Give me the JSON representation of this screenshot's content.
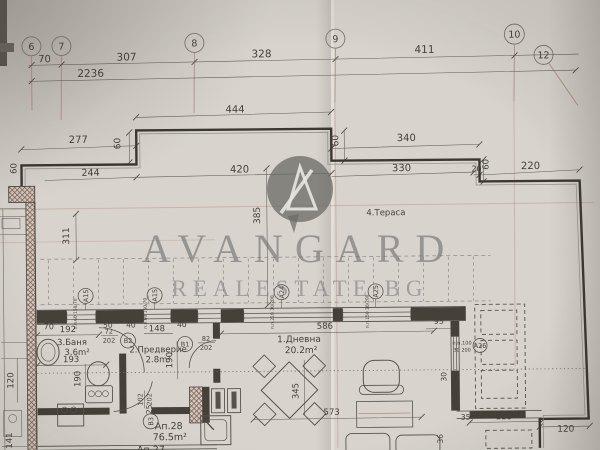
{
  "watermark": {
    "brand": "AVANGARD",
    "subtitle": "REALESTATE BG"
  },
  "grid_bubbles": {
    "b6": "6",
    "b7": "7",
    "b8": "8",
    "b9": "9",
    "b10": "10",
    "b12": "12"
  },
  "dims": {
    "d70": "70",
    "d307": "307",
    "d328": "328",
    "d411": "411",
    "d2236": "2236",
    "d444": "444",
    "d277": "277",
    "d340": "340",
    "d60": "60",
    "d244": "244",
    "d420": "420",
    "d330": "330",
    "d20": "20",
    "d220": "220",
    "d385": "385",
    "d311": "311",
    "d35": "35",
    "d192": "192",
    "d50": "50",
    "d40": "40",
    "d148": "148",
    "d193": "193",
    "d190": "190",
    "d120": "120",
    "d141": "141",
    "d25": "25",
    "d586": "586",
    "d95": "95",
    "d16": "16",
    "d30": "30",
    "d36": "36",
    "d345": "345",
    "d573": "573",
    "d118": "118"
  },
  "rooms": {
    "terrace": "4.Тераса",
    "bath_name": "3.Баня",
    "bath_area": "3.6m²",
    "hall_name": "2.Предверие",
    "hall_area": "2.8m²",
    "living_name": "1.Дневна",
    "living_area": "20.2m²"
  },
  "apartment": {
    "id": "Ап.28",
    "area": "76.5m²",
    "adjacent": "Ап.27"
  },
  "doors": {
    "b1_id": "B1",
    "b1_w": "82",
    "b1_h": "202",
    "b2_id": "B2",
    "b2_w": "72",
    "b2_h": "202",
    "b3_id": "B3",
    "b3_w": "102",
    "b3_h": "202"
  },
  "windows": {
    "a15_id": "A15",
    "a15_spec": "п.п.60 150/70",
    "a24_id": "A24",
    "a24_spec": "п.п.210 30/200",
    "a25_id": "A25",
    "a25_spec": "п.п.150 30/200",
    "a26_id": "A26",
    "a26_spec_1": "п.п.100",
    "a26_spec_2": "30 200"
  }
}
